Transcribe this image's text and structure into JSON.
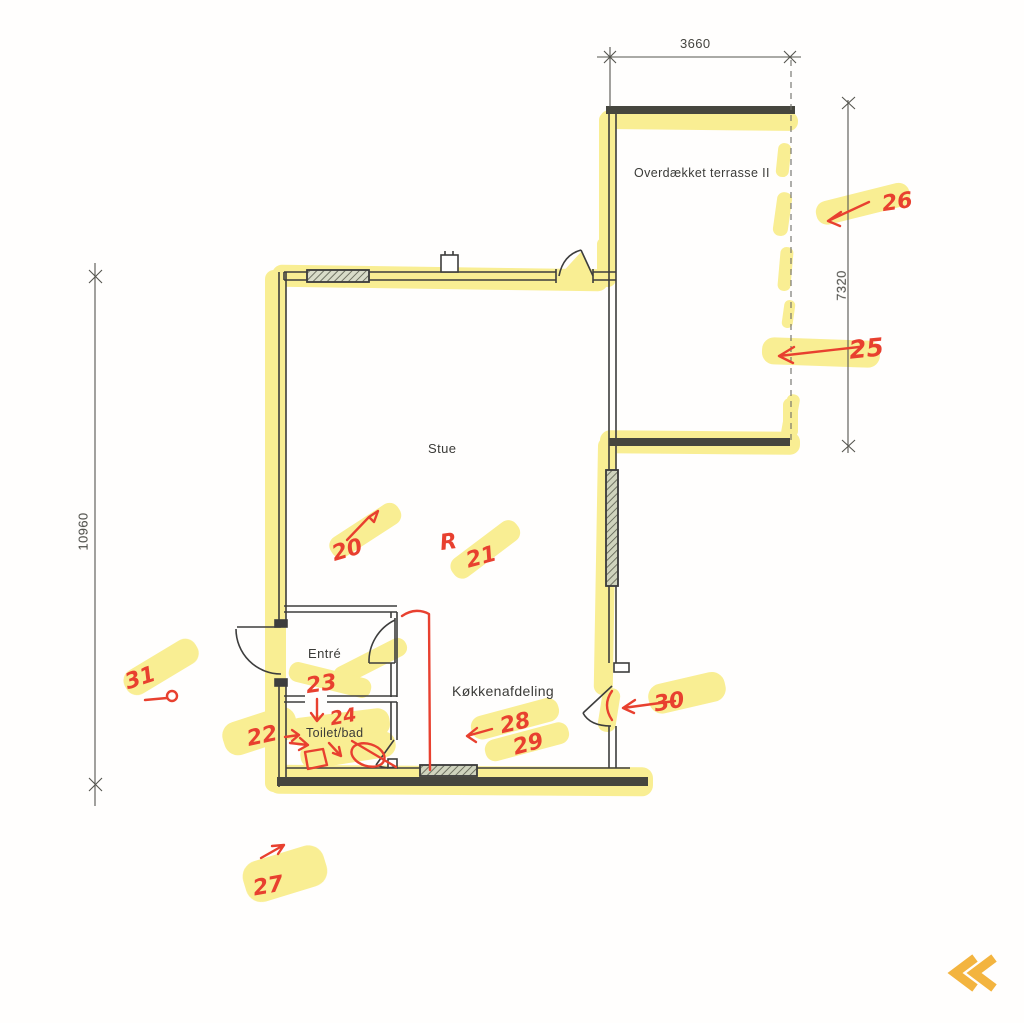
{
  "floor_plan": {
    "rooms": {
      "stue": "Stue",
      "entre": "Entré",
      "toilet": "Toilet/bad",
      "kitchen": "Køkkenafdeling",
      "terrace": "Overdækket terrasse II"
    },
    "dimensions": {
      "top": "3660",
      "right": "7320",
      "left": "10960"
    },
    "markups": {
      "m20": "20",
      "m21_letter": "R",
      "m21": "21",
      "m22": "22",
      "m23": "23",
      "m24": "24",
      "m25": "25",
      "m26": "26",
      "m27": "27",
      "m28": "28",
      "m29": "29",
      "m30": "30",
      "m31": "31"
    },
    "colors": {
      "highlighter_yellow": "#f4e13c",
      "red_pen": "#e8402f",
      "ink": "#3d3d3d",
      "nav_chevron": "#f3b43f"
    }
  },
  "viewer": {
    "prev_icon": "chevron-double-left"
  }
}
